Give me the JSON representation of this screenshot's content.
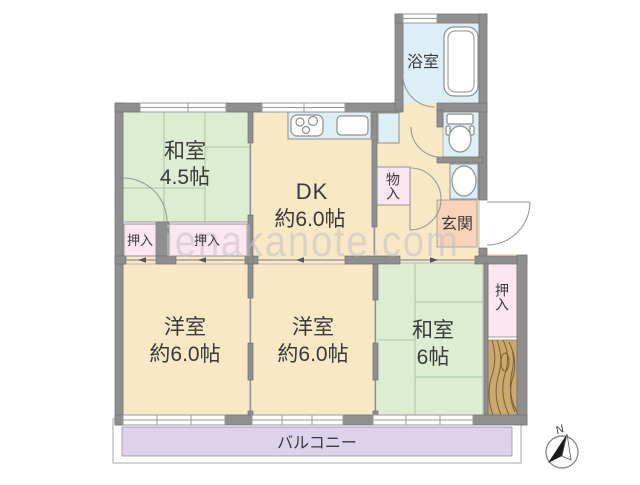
{
  "watermark": {
    "text": "ienakanote.com"
  },
  "compass": {
    "label": "N"
  },
  "rooms": {
    "washitsu_small": {
      "name": "和室",
      "size": "4.5帖"
    },
    "dk": {
      "name": "DK",
      "size": "約6.0帖"
    },
    "bathroom": {
      "name": "浴室"
    },
    "storage": {
      "name": "物入"
    },
    "genkan": {
      "name": "玄関"
    },
    "closet_left": {
      "name": "押入"
    },
    "closet_center": {
      "name": "押入"
    },
    "yoshitsu_left": {
      "name": "洋室",
      "size": "約6.0帖"
    },
    "yoshitsu_center": {
      "name": "洋室",
      "size": "約6.0帖"
    },
    "washitsu_right": {
      "name": "和室",
      "size": "6帖"
    },
    "closet_right": {
      "name": "押入"
    },
    "balcony": {
      "name": "バルコニー"
    }
  },
  "colors": {
    "wall": "#8f8f8f",
    "tatami_green": "#dcedd2",
    "flooring_cream": "#f8e8c6",
    "closet_pink": "#fbe6f1",
    "entrance_peach": "#f6d3b9",
    "wet_area_blue": "#dceef6",
    "balcony_purple": "#dcd2e9",
    "wood_tan": "#c9a96d"
  }
}
